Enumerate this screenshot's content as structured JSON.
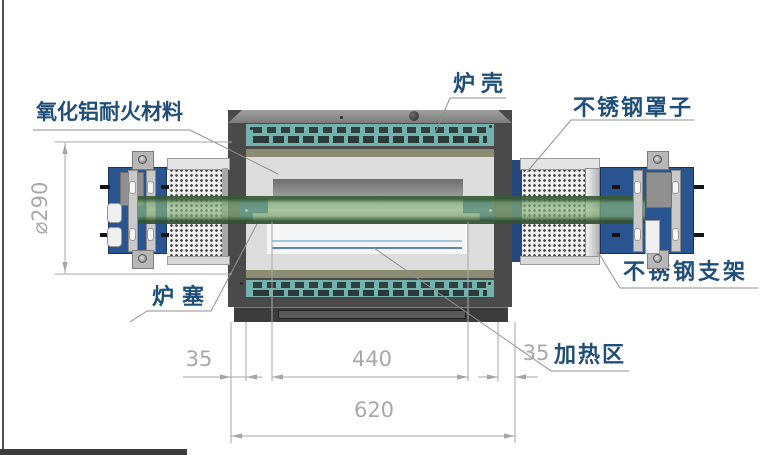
{
  "drawing": {
    "type": "tube-furnace-section-diagram",
    "labels": {
      "alumina_refractory": "氧化铝耐火材料",
      "furnace_shell": "炉壳",
      "stainless_cover": "不锈钢罩子",
      "furnace_plug": "炉塞",
      "stainless_bracket": "不锈钢支架",
      "heating_zone": "加热区"
    },
    "dimensions": {
      "diameter": "⌀290",
      "left_offset": "35",
      "heating_length": "440",
      "right_offset": "35",
      "overall_length": "620"
    },
    "colors": {
      "label_text": "#1f4e79",
      "dimension_text": "#a8a8a8",
      "shell_frame": "#4a4a4a",
      "vent_teal": "#74b2ae",
      "insulation_gray": "#dcdcdc",
      "tube_green": "#7daa73",
      "bracket_blue": "#2a5591",
      "plug_blue": "#2e5f99"
    }
  }
}
